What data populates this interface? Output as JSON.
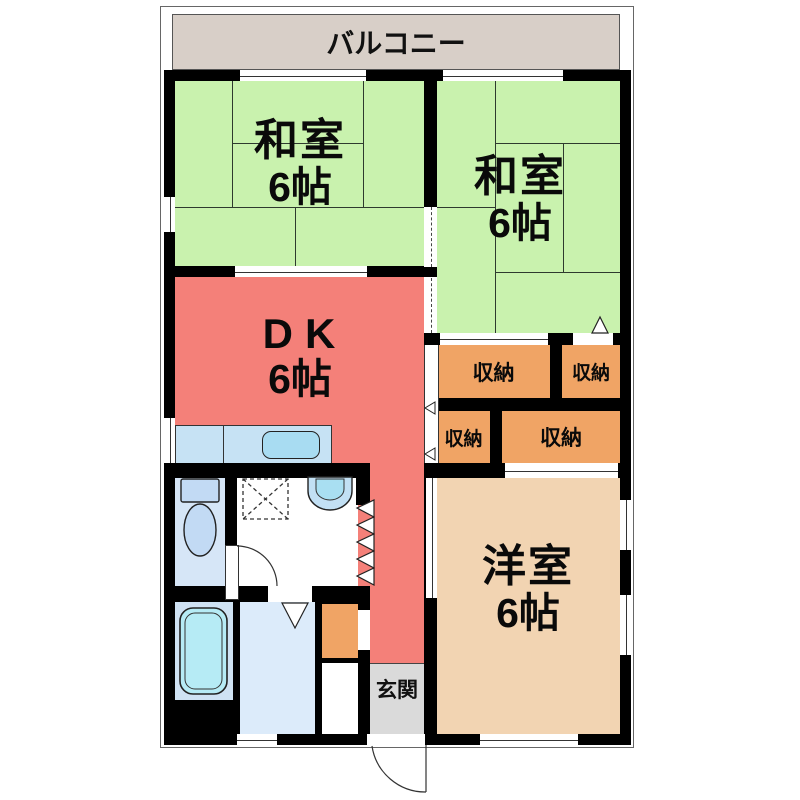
{
  "plan": {
    "title": "2DK apartment floor plan",
    "balcony": {
      "label": "バルコニー"
    },
    "rooms": {
      "washitsu_left": {
        "name": "和室",
        "size": "6帖"
      },
      "washitsu_right": {
        "name": "和室",
        "size": "6帖"
      },
      "dk": {
        "name": "DK",
        "size": "6帖"
      },
      "western": {
        "name": "洋室",
        "size": "6帖"
      },
      "genkan": {
        "name": "玄関"
      }
    },
    "closets": [
      "収納",
      "収納",
      "収納",
      "収納"
    ],
    "colors": {
      "tatami_room": "#c9f2ae",
      "dining_kitchen": "#f48079",
      "western_room": "#f2d4b2",
      "closet": "#f0a465",
      "balcony": "#d8cfc8",
      "entrance": "#dadada",
      "wall": "#000000",
      "bath_fixture": "#b6ebf5",
      "water_room": "#d6e6f7"
    }
  }
}
